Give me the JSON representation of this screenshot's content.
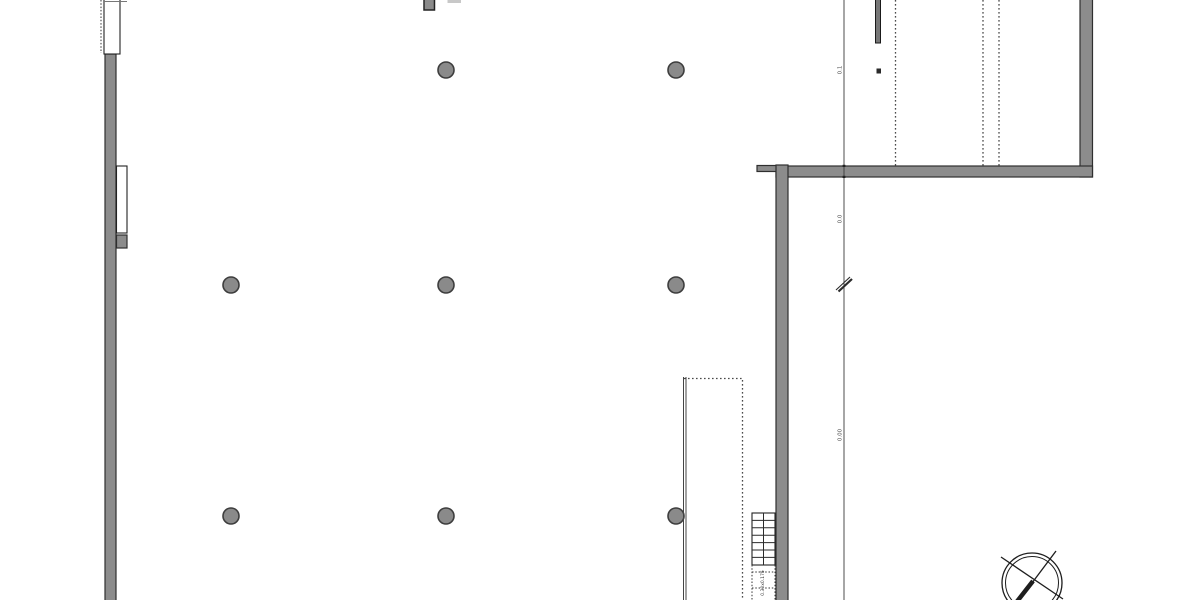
{
  "drawing": {
    "type": "architectural-floor-plan",
    "background": "#ffffff",
    "colors": {
      "wall_fill": "#8c8c8c",
      "wall_stroke": "#2f2f2f",
      "column_fill": "#8a8a8a",
      "column_stroke": "#3d3d3d",
      "line_color": "#2b2b2b",
      "dotted_line_color": "#4a4a4a",
      "light_bar_fill": "#c8c8c8"
    },
    "annotations": {
      "level_upper": "0.1",
      "level_mid": "0.0",
      "level_lower": "0.00",
      "stair_note": "0.30x0.175"
    },
    "columns": {
      "radius": 8,
      "positions": [
        [
          446,
          70
        ],
        [
          676,
          70
        ],
        [
          231,
          285
        ],
        [
          446,
          285
        ],
        [
          676,
          285
        ],
        [
          231,
          516
        ],
        [
          446,
          516
        ],
        [
          676,
          516
        ]
      ]
    }
  }
}
